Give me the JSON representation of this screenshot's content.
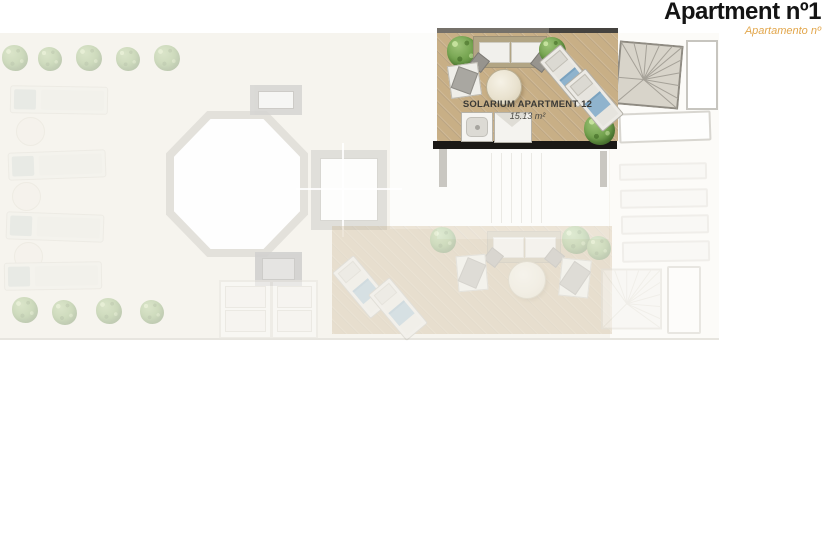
{
  "header": {
    "title": "Apartment nº1",
    "subtitle": "Apartamento nº"
  },
  "floorplan": {
    "highlighted_unit": {
      "name": "SOLARIUM APARTMENT 12",
      "area": "15.13 m²"
    },
    "colors": {
      "accent_orange": "#e2a64b",
      "title_black": "#141414",
      "wood_deck": "#c8af86",
      "wall_black": "#1b1916",
      "plant_green": "#74a34f",
      "towel_blue": "#8fb3cd",
      "skylight_gray": "#d9d8d4",
      "plan_background": "#f6f4ee"
    },
    "icons": {
      "staircase-icon": "svg square with fan lines",
      "sun-lounger-icon": "css rect with blue towel",
      "flat-lounger-icon": "css rect with pale pillow",
      "round-table-icon": "css circle",
      "sofa-icon": "css framed rect with cushions and pillows",
      "armchair-icon": "css square with rotated pillow",
      "plant-icon": "css foliage blob",
      "shower-tray-icon": "css nested rounded square with drain",
      "towel-bench-icon": "css envelope fold rect",
      "skylight-icon": "css nested rectangles",
      "octagon-skylight-icon": "css octagon ring",
      "door-panel-icon": "css framed panels"
    }
  }
}
